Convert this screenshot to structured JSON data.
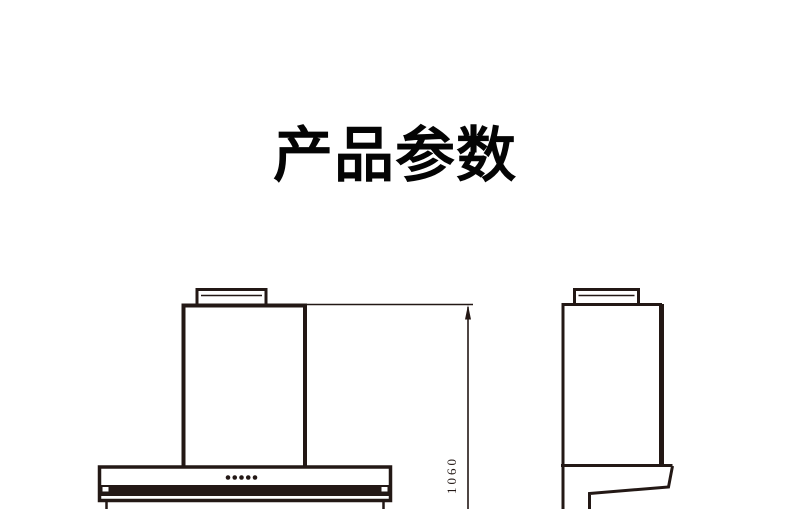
{
  "page": {
    "background_color": "#ffffff",
    "ink_color": "#231815",
    "title_color": "#040404"
  },
  "header": {
    "title": "产品参数"
  },
  "diagram": {
    "dimension_label": "1060",
    "control_dot_count": 5
  }
}
